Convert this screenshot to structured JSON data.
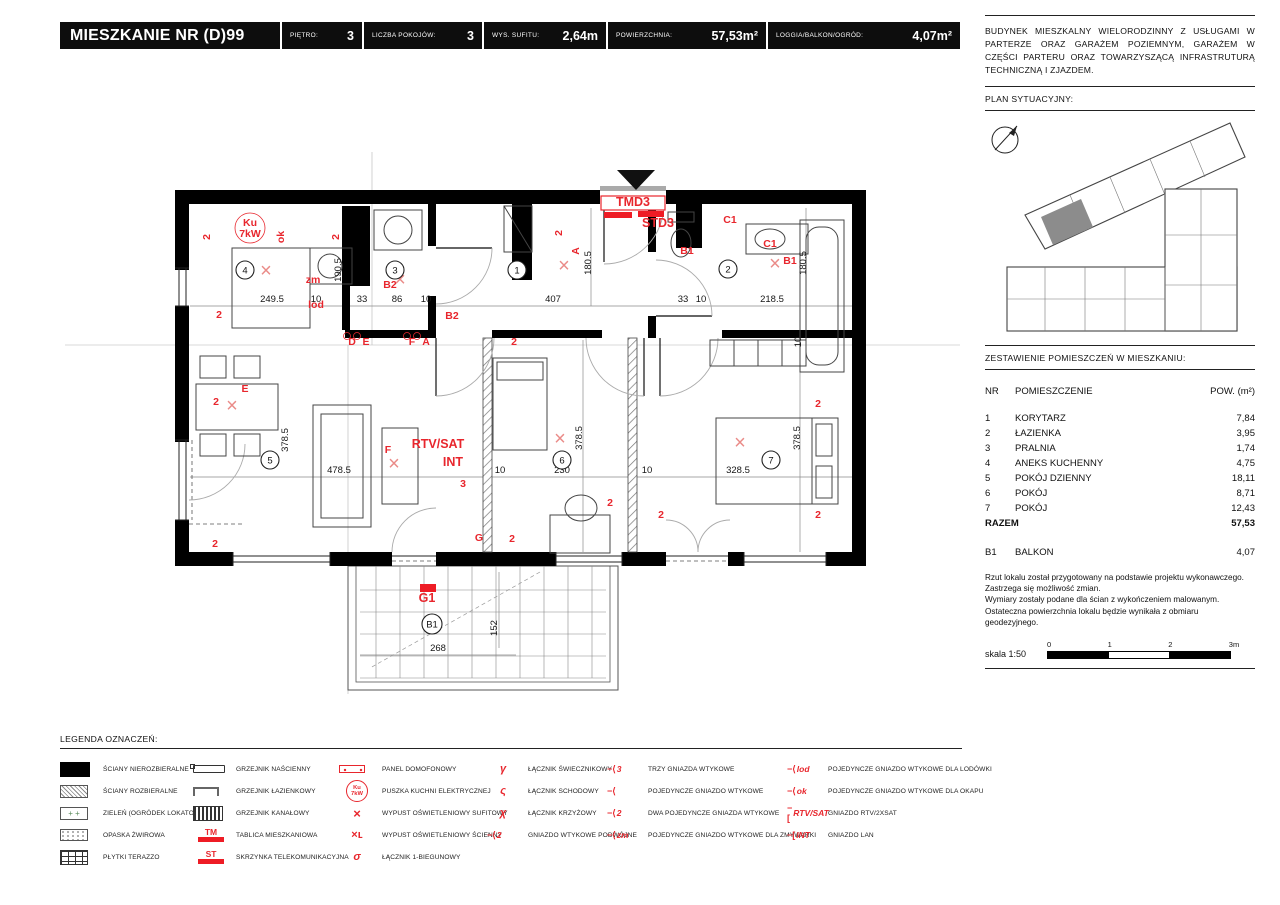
{
  "header": {
    "title": "MIESZKANIE NR (D)99",
    "fields": [
      {
        "label": "PIĘTRO:",
        "value": "3"
      },
      {
        "label": "LICZBA POKOJÓW:",
        "value": "3"
      },
      {
        "label": "WYS. SUFITU:",
        "value": "2,64m"
      },
      {
        "label": "POWIERZCHNIA:",
        "value": "57,53m²"
      },
      {
        "label": "LOGGIA/BALKON/OGRÓD:",
        "value": "4,07m²"
      }
    ]
  },
  "sidebar": {
    "building_description": "BUDYNEK MIESZKALNY WIELORODZINNY Z USŁUGAMI W PARTERZE ORAZ GARAŻEM POZIEMNYM, GARAŻEM W CZĘŚCI PARTERU ORAZ TOWARZYSZĄCĄ INFRASTRUTURĄ TECHNICZNĄ I ZJAZDEM.",
    "site_plan_label": "PLAN SYTUACYJNY:",
    "rooms_title": "ZESTAWIENIE POMIESZCZEŃ W MIESZKANIU:",
    "rooms_table": {
      "headers": {
        "nr": "NR",
        "name": "POMIESZCZENIE",
        "area": "POW. (m²)"
      },
      "rows": [
        [
          "1",
          "KORYTARZ",
          "7,84"
        ],
        [
          "2",
          "ŁAZIENKA",
          "3,95"
        ],
        [
          "3",
          "PRALNIA",
          "1,74"
        ],
        [
          "4",
          "ANEKS KUCHENNY",
          "4,75"
        ],
        [
          "5",
          "POKÓJ DZIENNY",
          "18,11"
        ],
        [
          "6",
          "POKÓJ",
          "8,71"
        ],
        [
          "7",
          "POKÓJ",
          "12,43"
        ]
      ],
      "total": {
        "label": "RAZEM",
        "value": "57,53"
      },
      "extra": {
        "nr": "B1",
        "name": "BALKON",
        "value": "4,07"
      }
    },
    "notes": [
      "Rzut lokalu został przygotowany na podstawie projektu wykonawczego.",
      "Zastrzega się możliwość zmian.",
      "Wymiary zostały podane dla ścian z wykończeniem malowanym.",
      "Ostateczna powierzchnia lokalu będzie wynikała z obmiaru",
      "geodezyjnego."
    ],
    "scale": {
      "label": "skala 1:50",
      "ticks": [
        "0",
        "1",
        "2",
        "3m"
      ]
    }
  },
  "legend": {
    "title": "LEGENDA OZNACZEŃ:",
    "groups": [
      {
        "items": [
          {
            "icon": "wall-solid",
            "label": "ŚCIANY NIEROZBIERALNE"
          },
          {
            "icon": "wall-hatch",
            "label": "ŚCIANY ROZBIERALNE"
          },
          {
            "icon": "green-area",
            "label": "ZIELEŃ (OGRÓDEK LOKATORSKI)"
          },
          {
            "icon": "gravel",
            "label": "OPASKA ŻWIROWA"
          },
          {
            "icon": "terrazzo",
            "label": "PŁYTKI TERAZZO"
          }
        ]
      },
      {
        "items": [
          {
            "icon": "radiator-wall",
            "label": "GRZEJNIK NAŚCIENNY"
          },
          {
            "icon": "radiator-bath",
            "label": "GRZEJNIK ŁAZIENKOWY"
          },
          {
            "icon": "radiator-channel",
            "label": "GRZEJNIK KANAŁOWY"
          },
          {
            "icon": "red-bar",
            "icon_text": "TM",
            "label": "TABLICA MIESZKANIOWA"
          },
          {
            "icon": "red-bar",
            "icon_text": "ST",
            "label": "SKRZYNKA TELEKOMUNIKACYJNA"
          }
        ]
      },
      {
        "items": [
          {
            "icon": "intercom",
            "label": "PANEL DOMOFONOWY"
          },
          {
            "icon": "kitchen-box",
            "icon_text": "Ku 7kW",
            "label": "PUSZKA KUCHNI ELEKTRYCZNEJ"
          },
          {
            "icon": "ceiling-light",
            "icon_text": "×",
            "label": "WYPUST OŚWIETLENIOWY SUFITOWY"
          },
          {
            "icon": "wall-light",
            "icon_text": "×ʟ",
            "label": "WYPUST OŚWIETLENIOWY ŚCIENNY"
          },
          {
            "icon": "switch-1",
            "icon_text": "σ",
            "label": "ŁĄCZNIK 1-BIEGUNOWY"
          }
        ]
      },
      {
        "items": [
          {
            "icon": "switch-chandelier",
            "icon_text": "γ",
            "label": "ŁĄCZNIK ŚWIECZNIKOWY"
          },
          {
            "icon": "switch-stairs",
            "icon_text": "ς",
            "label": "ŁĄCZNIK SCHODOWY"
          },
          {
            "icon": "switch-cross",
            "icon_text": "χ",
            "label": "ŁĄCZNIK KRZYŻOWY"
          },
          {
            "icon": "socket",
            "icon_text": "2",
            "label": "GNIAZDO WTYKOWE PODWÓJNE"
          }
        ]
      },
      {
        "items": [
          {
            "icon": "socket",
            "icon_text": "3",
            "label": "TRZY GNIAZDA WTYKOWE"
          },
          {
            "icon": "socket",
            "icon_text": "",
            "label": "POJEDYNCZE GNIAZDO WTYKOWE"
          },
          {
            "icon": "socket",
            "icon_text": "2",
            "label": "DWA POJEDYNCZE GNIAZDA WTYKOWE"
          },
          {
            "icon": "socket",
            "icon_text": "zm",
            "label": "POJEDYNCZE GNIAZDO WTYKOWE DLA ZMYWARKI"
          }
        ]
      },
      {
        "items": [
          {
            "icon": "socket",
            "icon_text": "lod",
            "label": "POJEDYNCZE GNIAZDO WTYKOWE DLA LODÓWKI"
          },
          {
            "icon": "socket",
            "icon_text": "ok",
            "label": "POJEDYNCZE GNIAZDO WTYKOWE DLA OKAPU"
          },
          {
            "icon": "socket-sq",
            "icon_text": "RTV/SAT",
            "label": "GNIAZDO RTV/2XSAT"
          },
          {
            "icon": "socket-sq",
            "icon_text": "INT",
            "label": "GNIAZDO LAN"
          }
        ]
      }
    ]
  },
  "floor_plan": {
    "labels": [
      {
        "x": 272,
        "y": 302,
        "t": "249.5",
        "c": "d"
      },
      {
        "x": 316,
        "y": 302,
        "t": "10",
        "c": "d"
      },
      {
        "x": 362,
        "y": 302,
        "t": "33",
        "c": "d"
      },
      {
        "x": 397,
        "y": 302,
        "t": "86",
        "c": "d"
      },
      {
        "x": 426,
        "y": 302,
        "t": "10",
        "c": "d"
      },
      {
        "x": 553,
        "y": 302,
        "t": "407",
        "c": "d"
      },
      {
        "x": 683,
        "y": 302,
        "t": "33",
        "c": "d"
      },
      {
        "x": 701,
        "y": 302,
        "t": "10",
        "c": "d"
      },
      {
        "x": 772,
        "y": 302,
        "t": "218.5",
        "c": "d"
      },
      {
        "x": 339,
        "y": 473,
        "t": "478.5",
        "c": "d"
      },
      {
        "x": 500,
        "y": 473,
        "t": "10",
        "c": "d"
      },
      {
        "x": 562,
        "y": 473,
        "t": "230",
        "c": "d"
      },
      {
        "x": 647,
        "y": 473,
        "t": "10",
        "c": "d"
      },
      {
        "x": 738,
        "y": 473,
        "t": "328.5",
        "c": "d"
      },
      {
        "x": 438,
        "y": 651,
        "t": "268",
        "c": "d"
      },
      {
        "x": 341,
        "y": 270,
        "t": "190.5",
        "c": "d9"
      },
      {
        "x": 591,
        "y": 263,
        "t": "180.5",
        "c": "d9"
      },
      {
        "x": 806,
        "y": 263,
        "t": "180.5",
        "c": "d9"
      },
      {
        "x": 288,
        "y": 440,
        "t": "378.5",
        "c": "d9"
      },
      {
        "x": 582,
        "y": 438,
        "t": "378.5",
        "c": "d9"
      },
      {
        "x": 800,
        "y": 438,
        "t": "378.5",
        "c": "d9"
      },
      {
        "x": 801,
        "y": 342,
        "t": "10",
        "c": "d9"
      },
      {
        "x": 497,
        "y": 628,
        "t": "152",
        "c": "d9"
      },
      {
        "x": 250,
        "y": 226,
        "t": "Ku",
        "c": "r"
      },
      {
        "x": 250,
        "y": 237,
        "t": "7kW",
        "c": "r"
      },
      {
        "x": 313,
        "y": 283,
        "t": "zm",
        "c": "r"
      },
      {
        "x": 316,
        "y": 308,
        "t": "lod",
        "c": "r"
      },
      {
        "x": 219,
        "y": 318,
        "t": "2",
        "c": "r"
      },
      {
        "x": 390,
        "y": 288,
        "t": "B2",
        "c": "r"
      },
      {
        "x": 452,
        "y": 319,
        "t": "B2",
        "c": "r"
      },
      {
        "x": 352,
        "y": 345,
        "t": "D",
        "c": "r"
      },
      {
        "x": 366,
        "y": 345,
        "t": "E",
        "c": "r"
      },
      {
        "x": 412,
        "y": 345,
        "t": "F",
        "c": "r"
      },
      {
        "x": 426,
        "y": 345,
        "t": "A",
        "c": "r"
      },
      {
        "x": 687,
        "y": 254,
        "t": "B1",
        "c": "r"
      },
      {
        "x": 790,
        "y": 264,
        "t": "B1",
        "c": "r"
      },
      {
        "x": 730,
        "y": 223,
        "t": "C1",
        "c": "r"
      },
      {
        "x": 770,
        "y": 247,
        "t": "C1",
        "c": "r"
      },
      {
        "x": 245,
        "y": 392,
        "t": "E",
        "c": "r"
      },
      {
        "x": 216,
        "y": 405,
        "t": "2",
        "c": "r"
      },
      {
        "x": 388,
        "y": 453,
        "t": "F",
        "c": "r"
      },
      {
        "x": 463,
        "y": 487,
        "t": "3",
        "c": "r"
      },
      {
        "x": 215,
        "y": 547,
        "t": "2",
        "c": "r"
      },
      {
        "x": 479,
        "y": 541,
        "t": "G",
        "c": "r"
      },
      {
        "x": 512,
        "y": 542,
        "t": "2",
        "c": "r"
      },
      {
        "x": 514,
        "y": 345,
        "t": "2",
        "c": "r"
      },
      {
        "x": 610,
        "y": 506,
        "t": "2",
        "c": "r"
      },
      {
        "x": 661,
        "y": 518,
        "t": "2",
        "c": "r"
      },
      {
        "x": 818,
        "y": 407,
        "t": "2",
        "c": "r"
      },
      {
        "x": 818,
        "y": 518,
        "t": "2",
        "c": "r"
      },
      {
        "x": 210,
        "y": 237,
        "t": "2",
        "c": "r9"
      },
      {
        "x": 284,
        "y": 237,
        "t": "ok",
        "c": "r9"
      },
      {
        "x": 339,
        "y": 237,
        "t": "2",
        "c": "r9"
      },
      {
        "x": 562,
        "y": 233,
        "t": "2",
        "c": "r9"
      },
      {
        "x": 579,
        "y": 251,
        "t": "A",
        "c": "r9"
      },
      {
        "x": 633,
        "y": 206,
        "t": "TMD3",
        "c": "rb"
      },
      {
        "x": 658,
        "y": 227,
        "t": "STD3",
        "c": "rb"
      },
      {
        "x": 438,
        "y": 448,
        "t": "RTV/SAT",
        "c": "rb"
      },
      {
        "x": 453,
        "y": 466,
        "t": "INT",
        "c": "rb"
      },
      {
        "x": 427,
        "y": 602,
        "t": "G1",
        "c": "rb"
      },
      {
        "x": 266,
        "y": 277,
        "t": "×",
        "c": "x"
      },
      {
        "x": 400,
        "y": 286,
        "t": "×",
        "c": "x"
      },
      {
        "x": 564,
        "y": 272,
        "t": "×",
        "c": "x"
      },
      {
        "x": 775,
        "y": 270,
        "t": "×",
        "c": "x"
      },
      {
        "x": 232,
        "y": 412,
        "t": "×",
        "c": "x"
      },
      {
        "x": 394,
        "y": 470,
        "t": "×",
        "c": "x"
      },
      {
        "x": 560,
        "y": 445,
        "t": "×",
        "c": "x"
      },
      {
        "x": 740,
        "y": 449,
        "t": "×",
        "c": "x"
      }
    ],
    "room_markers": [
      {
        "x": 245,
        "y": 270,
        "n": "4"
      },
      {
        "x": 395,
        "y": 270,
        "n": "3"
      },
      {
        "x": 517,
        "y": 270,
        "n": "1"
      },
      {
        "x": 728,
        "y": 269,
        "n": "2"
      },
      {
        "x": 270,
        "y": 460,
        "n": "5"
      },
      {
        "x": 562,
        "y": 460,
        "n": "6"
      },
      {
        "x": 771,
        "y": 460,
        "n": "7"
      },
      {
        "x": 432,
        "y": 624,
        "n": "B1"
      }
    ]
  },
  "colors": {
    "accent_red": "#e8262d",
    "bar_red": "#ee1c25",
    "wall_black": "#000000"
  }
}
